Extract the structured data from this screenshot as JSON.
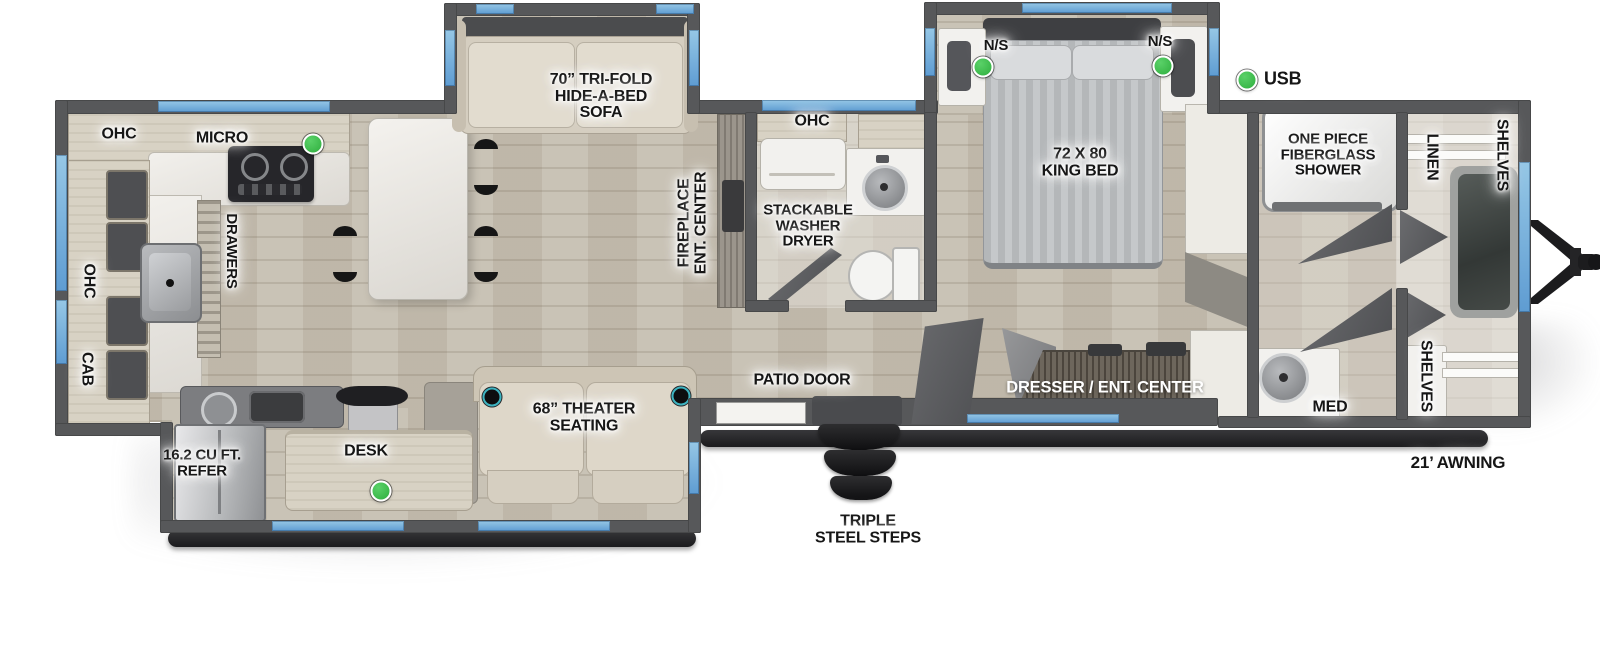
{
  "legend": {
    "usb": "USB"
  },
  "kitchen": {
    "ohc_top": "OHC",
    "micro": "MICRO",
    "ohc_side": "OHC",
    "cab": "CAB",
    "drawers": "DRAWERS"
  },
  "living": {
    "sofa": "70” TRI-FOLD\nHIDE-A-BED\nSOFA",
    "fireplace": "FIREPLACE\nENT. CENTER",
    "patio_door": "PATIO DOOR",
    "steps": "TRIPLE\nSTEEL STEPS"
  },
  "bottom_slide": {
    "refer": "16.2 CU FT.\nREFER",
    "desk": "DESK",
    "theater": "68” THEATER\nSEATING"
  },
  "bathroom": {
    "ohc": "OHC",
    "washer_dryer": "STACKABLE\nWASHER\nDRYER"
  },
  "bedroom": {
    "bed": "72 X 80\nKING BED",
    "nightstand_left": "N/S",
    "nightstand_right": "N/S",
    "dresser": "DRESSER / ENT. CENTER"
  },
  "front_bath": {
    "shower": "ONE PIECE\nFIBERGLASS\nSHOWER",
    "med": "MED",
    "linen": "LINEN",
    "shelves_top": "SHELVES",
    "shelves_bottom": "SHELVES"
  },
  "exterior": {
    "awning": "21’ AWNING"
  },
  "colors": {
    "wall": "#57585a",
    "window": "#6fa9d8",
    "floor": "#c6bfb1",
    "counter": "#d8d2c4",
    "fixture_white": "#f2f1ee",
    "usb_green": "#2fae3e",
    "cupholder_ring": "#3db3c0",
    "awning_black": "#1b1b1d"
  }
}
